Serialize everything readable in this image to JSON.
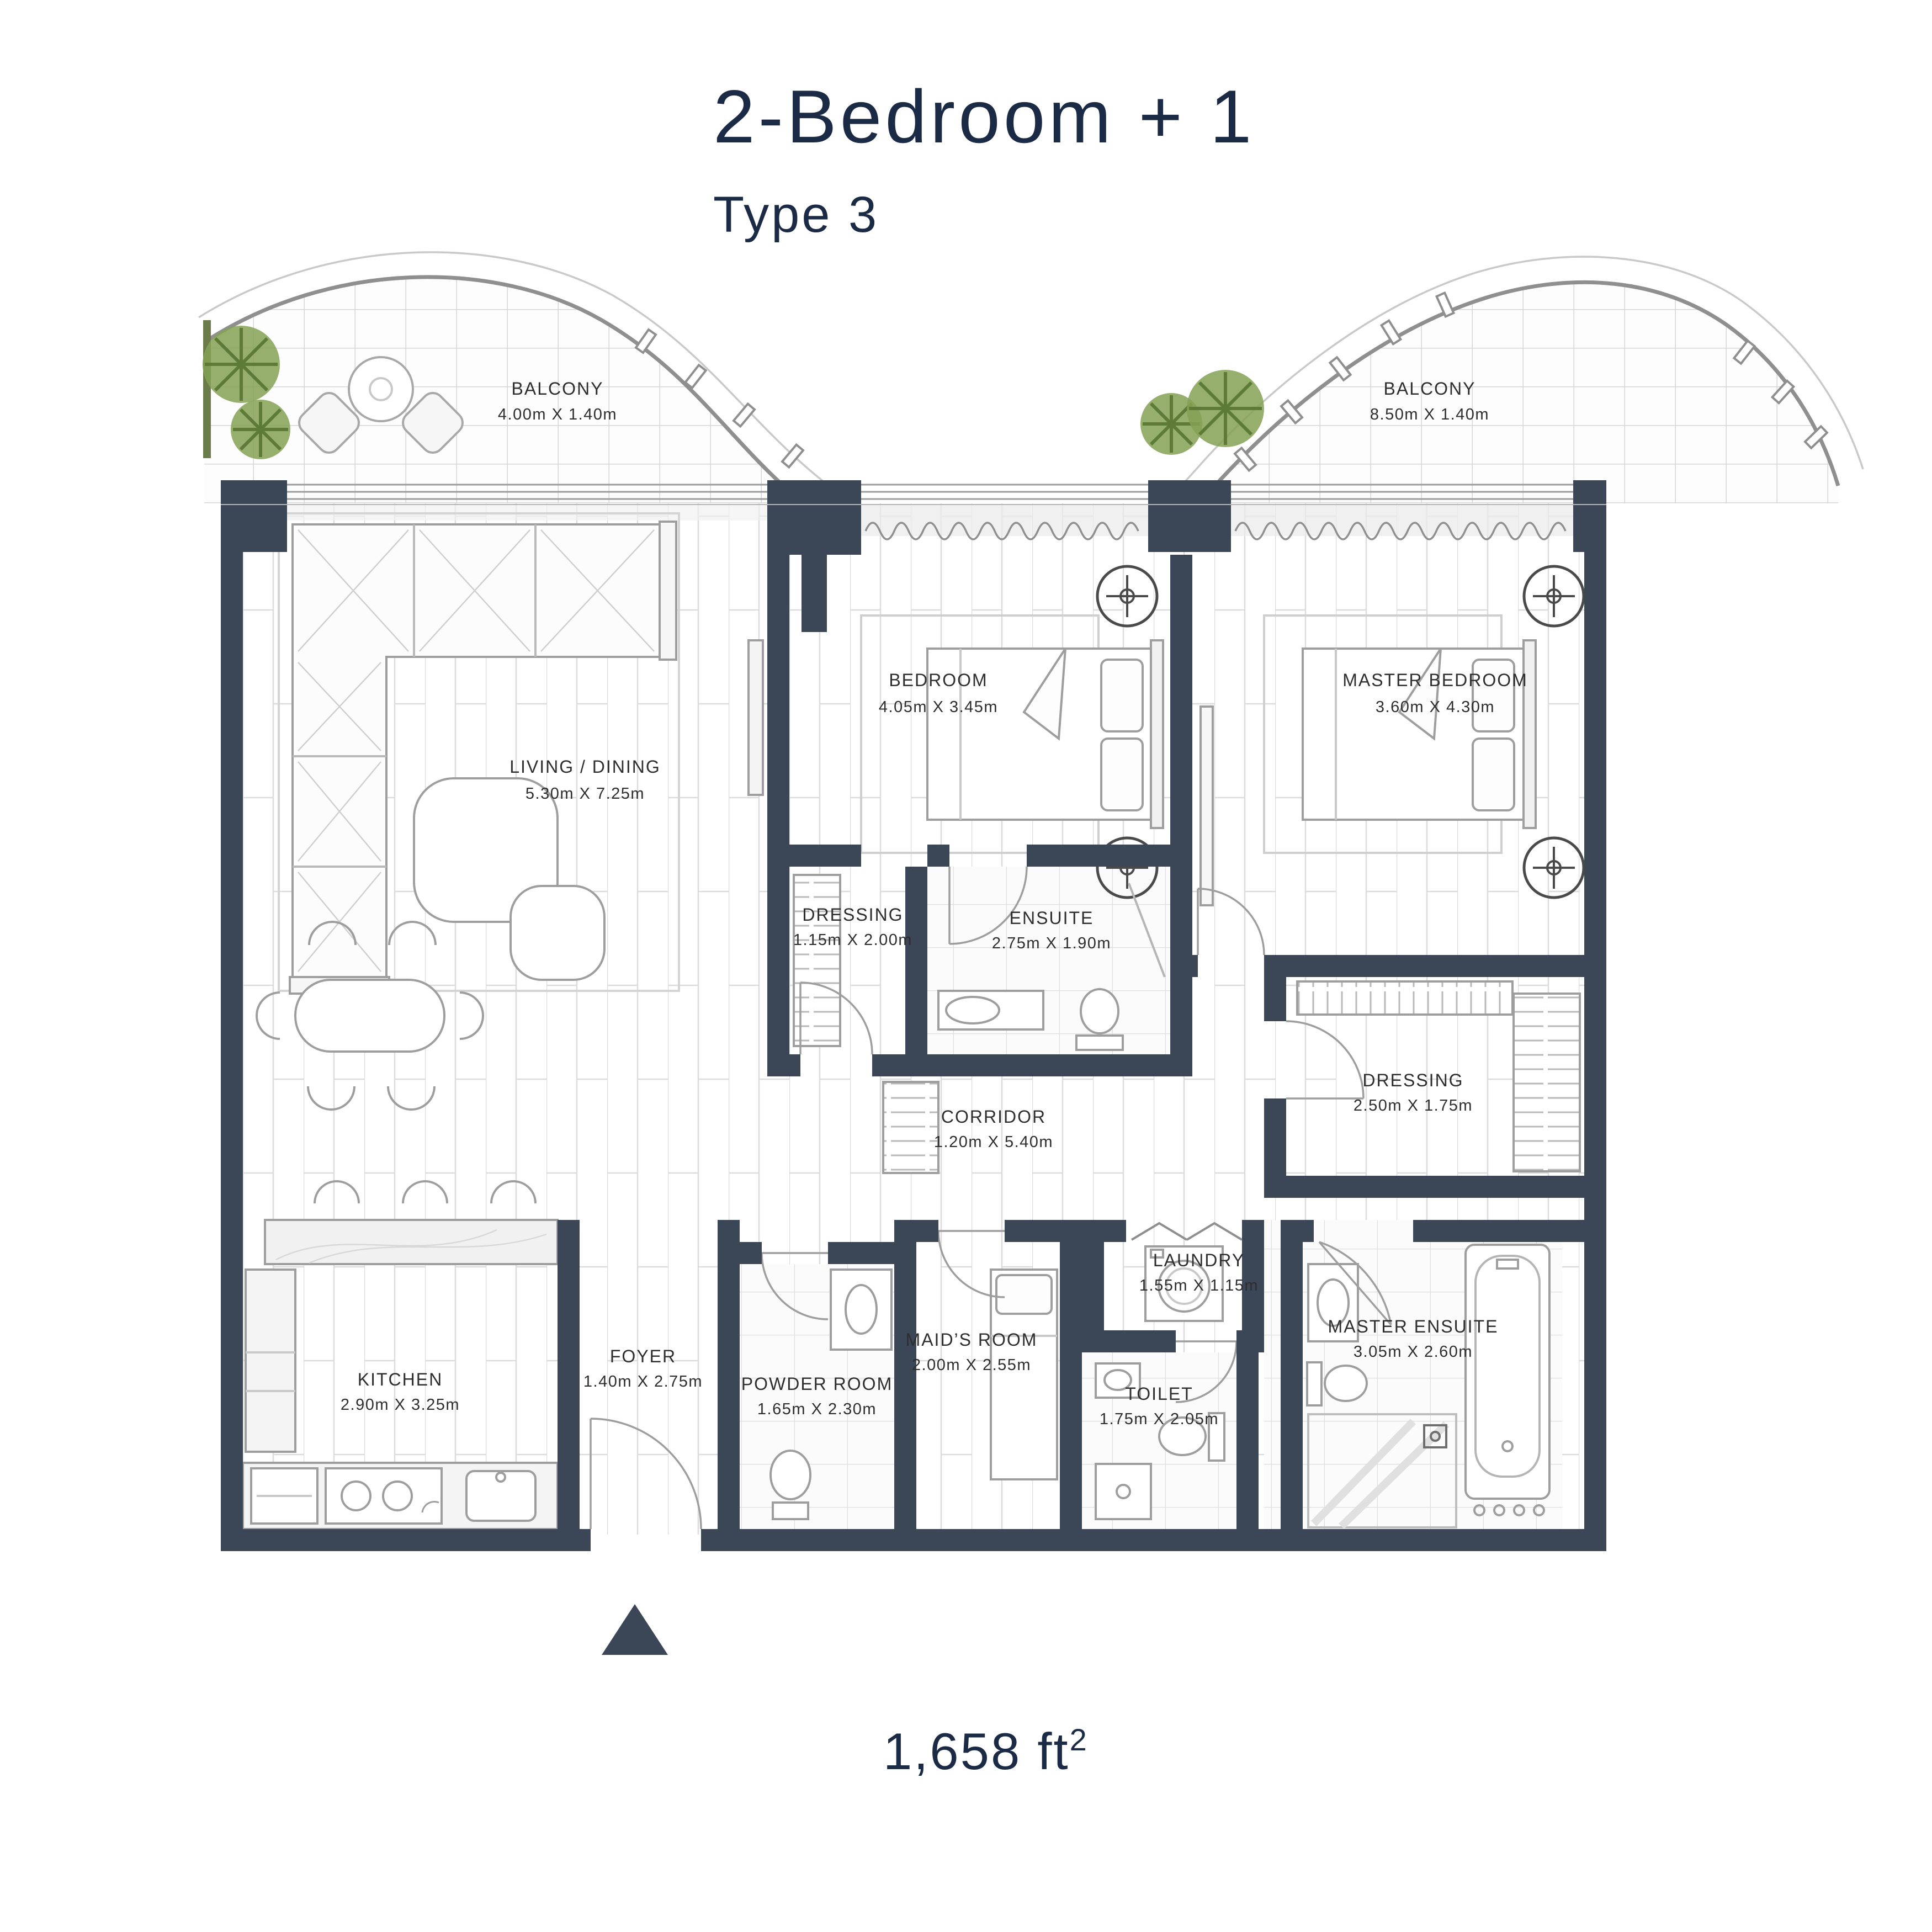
{
  "title": "2-Bedroom + 1",
  "subtitle": "Type 3",
  "area": {
    "value": "1,658 ft",
    "sup": "2"
  },
  "colors": {
    "wall": "#3b4656",
    "title_text": "#1b2b45",
    "label_text": "#2e2e2e",
    "plant_green": "#84a154",
    "plant_stroke": "#5d7a36",
    "floor_line": "#d9d9d9",
    "furniture_stroke": "#9e9e9e"
  },
  "rooms": [
    {
      "id": "balcony-left",
      "name": "BALCONY",
      "dims": "4.00m X 1.40m"
    },
    {
      "id": "balcony-right",
      "name": "BALCONY",
      "dims": "8.50m X 1.40m"
    },
    {
      "id": "living-dining",
      "name": "LIVING / DINING",
      "dims": "5.30m X 7.25m"
    },
    {
      "id": "bedroom",
      "name": "BEDROOM",
      "dims": "4.05m X 3.45m"
    },
    {
      "id": "master-bedroom",
      "name": "MASTER BEDROOM",
      "dims": "3.60m X 4.30m"
    },
    {
      "id": "dressing-1",
      "name": "DRESSING",
      "dims": "1.15m X 2.00m"
    },
    {
      "id": "ensuite",
      "name": "ENSUITE",
      "dims": "2.75m X 1.90m"
    },
    {
      "id": "corridor",
      "name": "CORRIDOR",
      "dims": "1.20m X 5.40m"
    },
    {
      "id": "dressing-master",
      "name": "DRESSING",
      "dims": "2.50m X 1.75m"
    },
    {
      "id": "laundry",
      "name": "LAUNDRY",
      "dims": "1.55m X 1.15m"
    },
    {
      "id": "maids-room",
      "name": "MAID’S ROOM",
      "dims": "2.00m X 2.55m"
    },
    {
      "id": "toilet",
      "name": "TOILET",
      "dims": "1.75m X 2.05m"
    },
    {
      "id": "master-ensuite",
      "name": "MASTER ENSUITE",
      "dims": "3.05m X 2.60m"
    },
    {
      "id": "kitchen",
      "name": "KITCHEN",
      "dims": "2.90m X 3.25m"
    },
    {
      "id": "foyer",
      "name": "FOYER",
      "dims": "1.40m X 2.75m"
    },
    {
      "id": "powder-room",
      "name": "POWDER ROOM",
      "dims": "1.65m X 2.30m"
    }
  ]
}
